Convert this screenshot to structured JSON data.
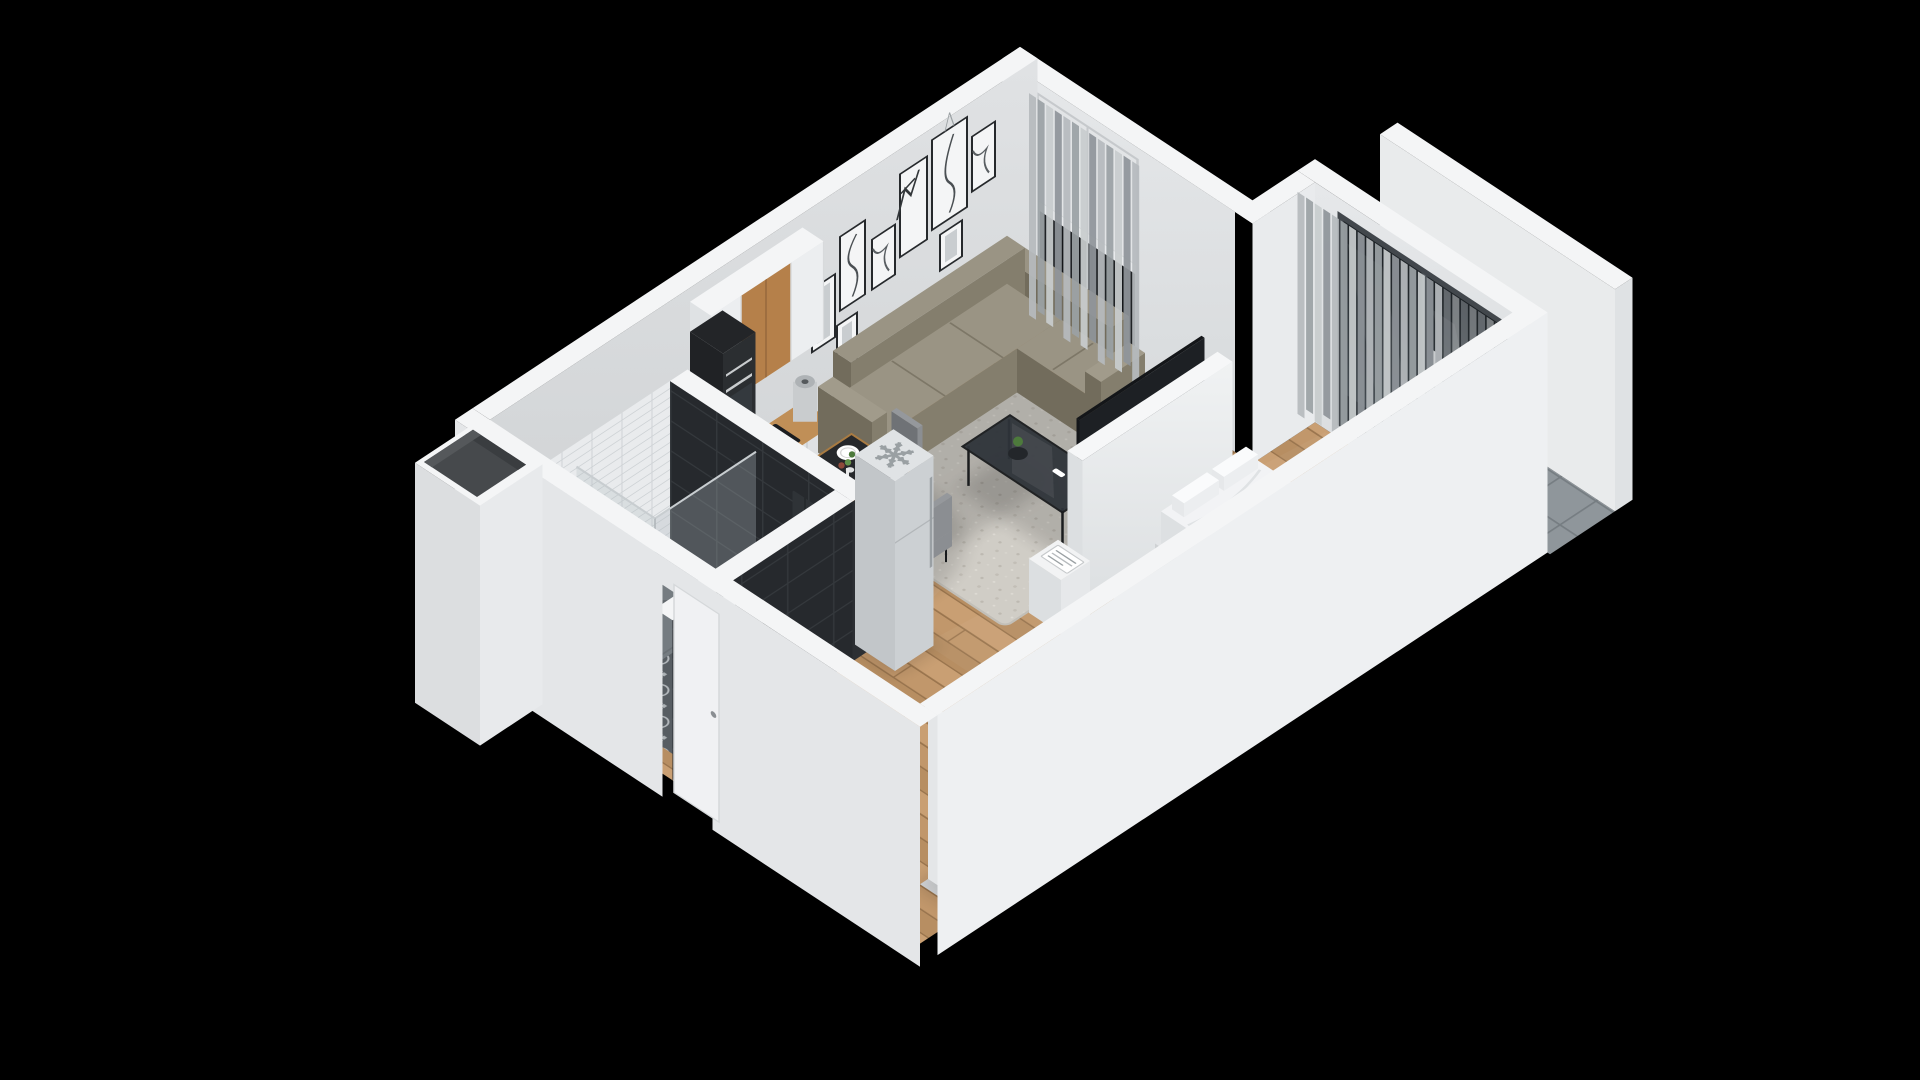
{
  "title": "isometric-apartment-floor-plan",
  "background": "#000000",
  "scene": {
    "type": "3d-isometric-floor-plan",
    "rooms": [
      "living-room",
      "dining-area",
      "kitchen",
      "bathroom",
      "sleeping-area",
      "balcony",
      "entry-corridor"
    ],
    "items": [
      "corner-sofa",
      "area-rug",
      "coffee-table",
      "dining-table",
      "dining-chairs",
      "wall-art",
      "window-with-railing",
      "curtains",
      "kitchen-upper-cabinets",
      "kitchen-counter",
      "cooktop",
      "oven-column",
      "coffee-machine",
      "kettle",
      "kitchen-sink",
      "fridge",
      "bathroom-black-tile-walls",
      "shower",
      "mosaic-floor",
      "vanity-sink",
      "towel",
      "ventilation-shaft",
      "tv-partition",
      "tv",
      "nightstand",
      "bed",
      "bed-runner",
      "bed-rug",
      "side-table",
      "dresser",
      "plant",
      "wardrobe-with-clothes",
      "sliding-glass-door",
      "balcony-parapet",
      "entry-door",
      "bathroom-door"
    ]
  },
  "palette": {
    "background": "#000000",
    "wall_top": "#f4f5f6",
    "wall_nw_face": "#d7d9db",
    "wall_ne_face": "#e0e2e4",
    "wall_bay_face": "#e9ebed",
    "wall_outer_se": "#eef0f2",
    "wall_outer_sw": "#e4e6e8",
    "floor_wood": "#c1976b",
    "floor_wood_mid": "#b78e62",
    "floor_wood_light": "#c99f73",
    "floor_wood_line": "#9a754e",
    "rug": "#d0cdc6",
    "rug_dot": "#bdb9b1",
    "bed_rug": "#ededeb",
    "mosaic_base": "#575d62",
    "mosaic_motif": "#c3c8cb",
    "tile_black": "#26292d",
    "tile_black_line": "#34383c",
    "subway": "#e9ebed",
    "subway_line": "#cfd3d6",
    "balcony_tile": "#8f969b",
    "balcony_line": "#767d82",
    "sofa_top": "#9a9484",
    "sofa_front": "#847e6d",
    "sofa_side": "#726c5c",
    "sofa_seam": "#7d7767",
    "coffee_frame": "#1a1c1e",
    "coffee_glass": "#2f343a",
    "table_top": "#26282b",
    "table_rim": "#a97b42",
    "chair": "#8b8e92",
    "chair_top": "#95989c",
    "chair_dark": "#6f7276",
    "cab_white": "#eceef0",
    "cab_wood": "#b5804a",
    "counter_wood": "#c08f57",
    "appl_dark": "#232528",
    "steel": "#c9ccce",
    "fridge": "#ccd0d3",
    "fridge_side": "#c2c6c9",
    "fridge_top": "#e0e3e5",
    "snowflake": "#9aa0a3",
    "tv": "#141619",
    "partition": "#e9ebed",
    "bed_white": "#f2f3f5",
    "bed_platform": "#e3e5e7",
    "runner": "#9aa0a3",
    "runner_line": "#7f858a",
    "curtains": [
      "#b6babd",
      "#9ba1a5",
      "#c8ccce",
      "#8f959a"
    ],
    "glass": "#aeb8be",
    "door_glass": "#1d2226",
    "door_glass_light": "#4a5258",
    "door_frame": "#42474c",
    "clothes": [
      "#3a3f46",
      "#2e3d55",
      "#6b4a33",
      "#555a61",
      "#23262b",
      "#7a8089",
      "#4a3b2e"
    ],
    "books": [
      "#3f6d5a",
      "#b3552e",
      "#32506e",
      "#c9cccf",
      "#6b4a33"
    ],
    "plant": "#4d7a3c",
    "plant_light": "#5f924a",
    "orange": "#e07820",
    "red": "#c03b2a",
    "white": "#f6f7f8",
    "black": "#17191c"
  }
}
